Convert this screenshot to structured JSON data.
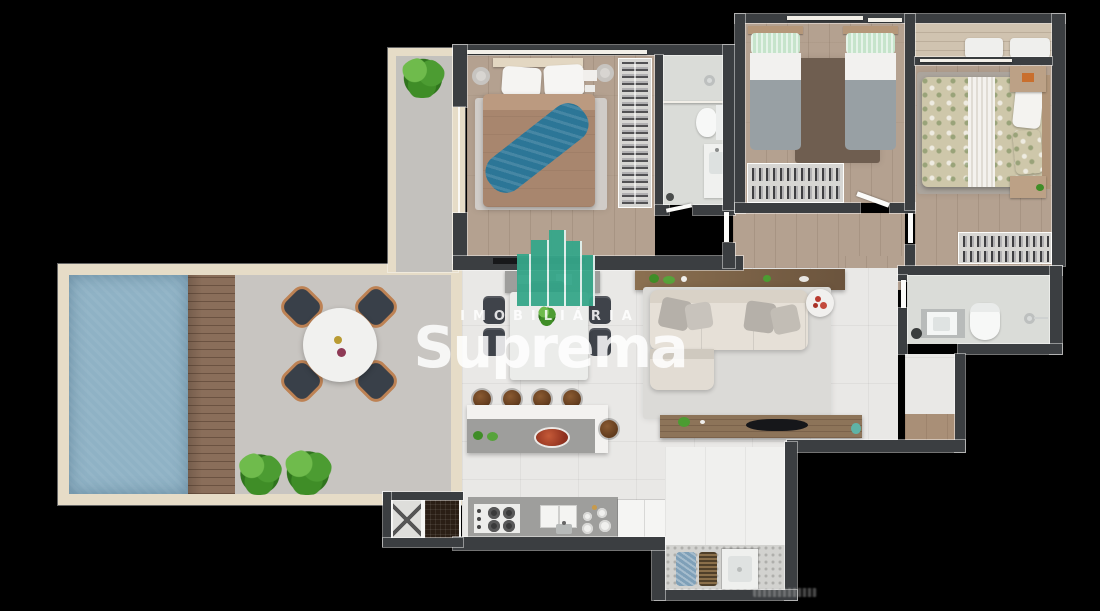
{
  "watermark": {
    "brand_top": "IMOBILIÁRIA",
    "brand_main": "Suprema",
    "logo_color": "#36a78a",
    "text_color": "#ffffff"
  },
  "render_credit": {
    "present": true,
    "legible": false
  },
  "palette": {
    "background": "#000000",
    "wall_dark": "#3b3e41",
    "wall_cream": "#e6dcc7",
    "wood_floor": "#b4a190",
    "balcony_wood": "#d0c3b0",
    "tile_floor": "#e9e8e6",
    "terrace_floor": "#c8c5c1",
    "pool_water": "#8fb2c5",
    "deck_wood": "#8a6e5a",
    "counter_gray": "#9e9e9c",
    "sofa_beige": "#e6e0d7",
    "duvet_brown": "#a8866e",
    "throw_blue": "#2c7697",
    "pillow_green": "#c6e4cb",
    "floral_base": "#cec7aa",
    "bath_floor": "#dadcd8",
    "rug_dark_brown": "#6f5e50",
    "blanket_gray": "#98a0a4"
  },
  "plan": {
    "view": "top-down 3d apartment floor plan render on black background",
    "rooms": [
      {
        "name": "terrace",
        "features": [
          "swimming-pool",
          "wood-deck",
          "round-dining-table",
          "four-chairs",
          "two-plants"
        ]
      },
      {
        "name": "side-balcony",
        "features": [
          "plant"
        ]
      },
      {
        "name": "master-suite",
        "features": [
          "double-bed",
          "blue-throw",
          "rug",
          "wardrobe-rack",
          "wall-tv"
        ]
      },
      {
        "name": "ensuite-bathroom",
        "features": [
          "shower",
          "toilet",
          "vanity-sink"
        ]
      },
      {
        "name": "twin-bedroom",
        "features": [
          "single-bed",
          "single-bed",
          "dark-rug",
          "wardrobe-rack"
        ]
      },
      {
        "name": "second-bedroom",
        "features": [
          "floral-double-bed",
          "rug",
          "two-nightstands",
          "wardrobe-rack",
          "balcony-with-cushions"
        ]
      },
      {
        "name": "social-bathroom",
        "features": [
          "vanity-sink",
          "toilet",
          "shower"
        ]
      },
      {
        "name": "hallway",
        "features": [
          "doors"
        ]
      },
      {
        "name": "living-room",
        "features": [
          "l-shaped-sofa",
          "rug",
          "sideboard",
          "round-side-table",
          "tv-bench"
        ]
      },
      {
        "name": "dining-area",
        "features": [
          "table",
          "six-chairs",
          "plant-centerpiece"
        ]
      },
      {
        "name": "kitchen",
        "features": [
          "island-with-stools",
          "cooktop",
          "sink",
          "fridge",
          "counter"
        ]
      },
      {
        "name": "laundry",
        "features": [
          "laundry-tub",
          "clothes-baskets"
        ]
      },
      {
        "name": "elevator",
        "features": [
          "elevator-shaft",
          "pantry"
        ]
      },
      {
        "name": "entry-foyer",
        "features": [
          "door",
          "wood-mat"
        ]
      }
    ]
  }
}
